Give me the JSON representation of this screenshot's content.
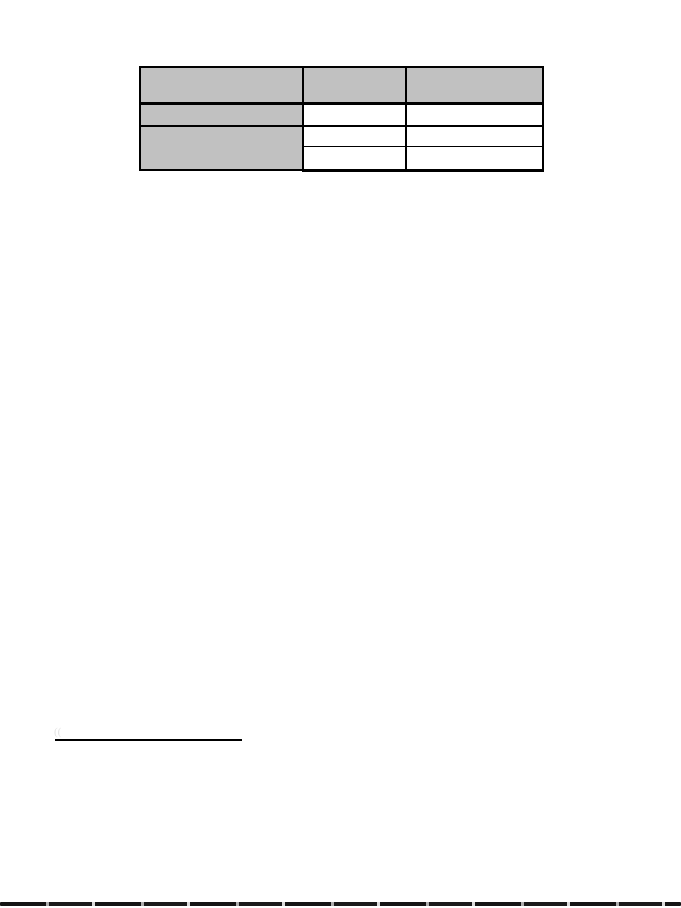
{
  "document": {
    "background_color": "#ffffff",
    "table": {
      "columns": 3,
      "header_fill": "#c1c1c1",
      "label_column_fill": "#c1c1c1",
      "body_fill": "#ffffff",
      "border_color": "#000000",
      "rows": [
        {
          "cells": [
            "",
            "",
            ""
          ]
        },
        {
          "cells": [
            "",
            "",
            ""
          ]
        },
        {
          "cells": [
            "",
            "",
            ""
          ]
        },
        {
          "cells": [
            "",
            ""
          ]
        }
      ]
    },
    "footnote": {
      "has_separator_rule": true,
      "artifact_mark": "(("
    },
    "page_edge_color": "#141414"
  }
}
